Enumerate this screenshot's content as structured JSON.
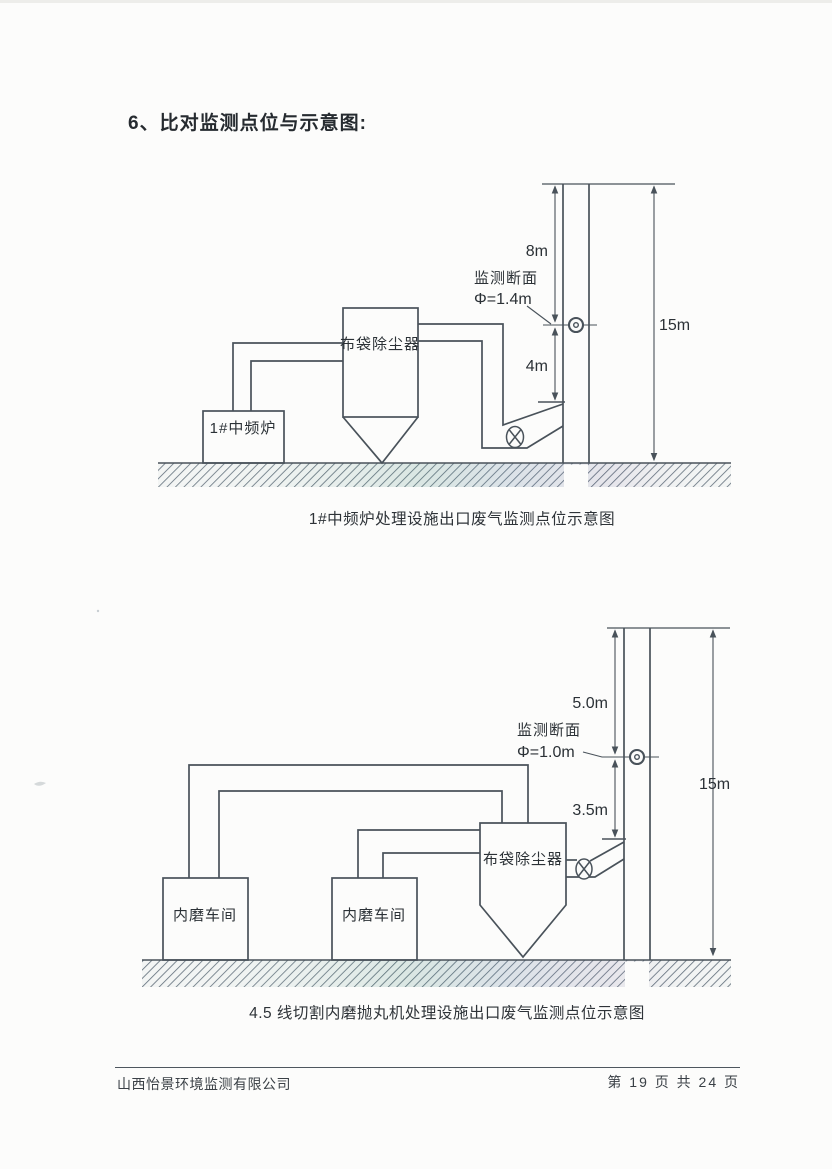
{
  "page": {
    "heading": "6、比对监测点位与示意图:",
    "footer": {
      "company": "山西怡景环境监测有限公司",
      "page_info": "第 19 页 共 24 页"
    }
  },
  "diagram1": {
    "caption": "1#中频炉处理设施出口废气监测点位示意图",
    "labels": {
      "dim_upper": "8m",
      "dim_lower": "4m",
      "stack_height": "15m",
      "section": "监测断面",
      "diameter": "Φ=1.4m",
      "collector": "布袋除尘器",
      "source": "1#中频炉"
    }
  },
  "diagram2": {
    "caption": "4.5 线切割内磨抛丸机处理设施出口废气监测点位示意图",
    "labels": {
      "dim_upper": "5.0m",
      "dim_lower": "3.5m",
      "stack_height": "15m",
      "section": "监测断面",
      "diameter": "Φ=1.0m",
      "collector": "布袋除尘器",
      "workshop_a": "内磨车间",
      "workshop_b": "内磨车间"
    }
  },
  "colors": {
    "line": "#49525a",
    "text": "#2b3136",
    "hatch": "#5e6c78",
    "paper": "#fcfcfb"
  }
}
